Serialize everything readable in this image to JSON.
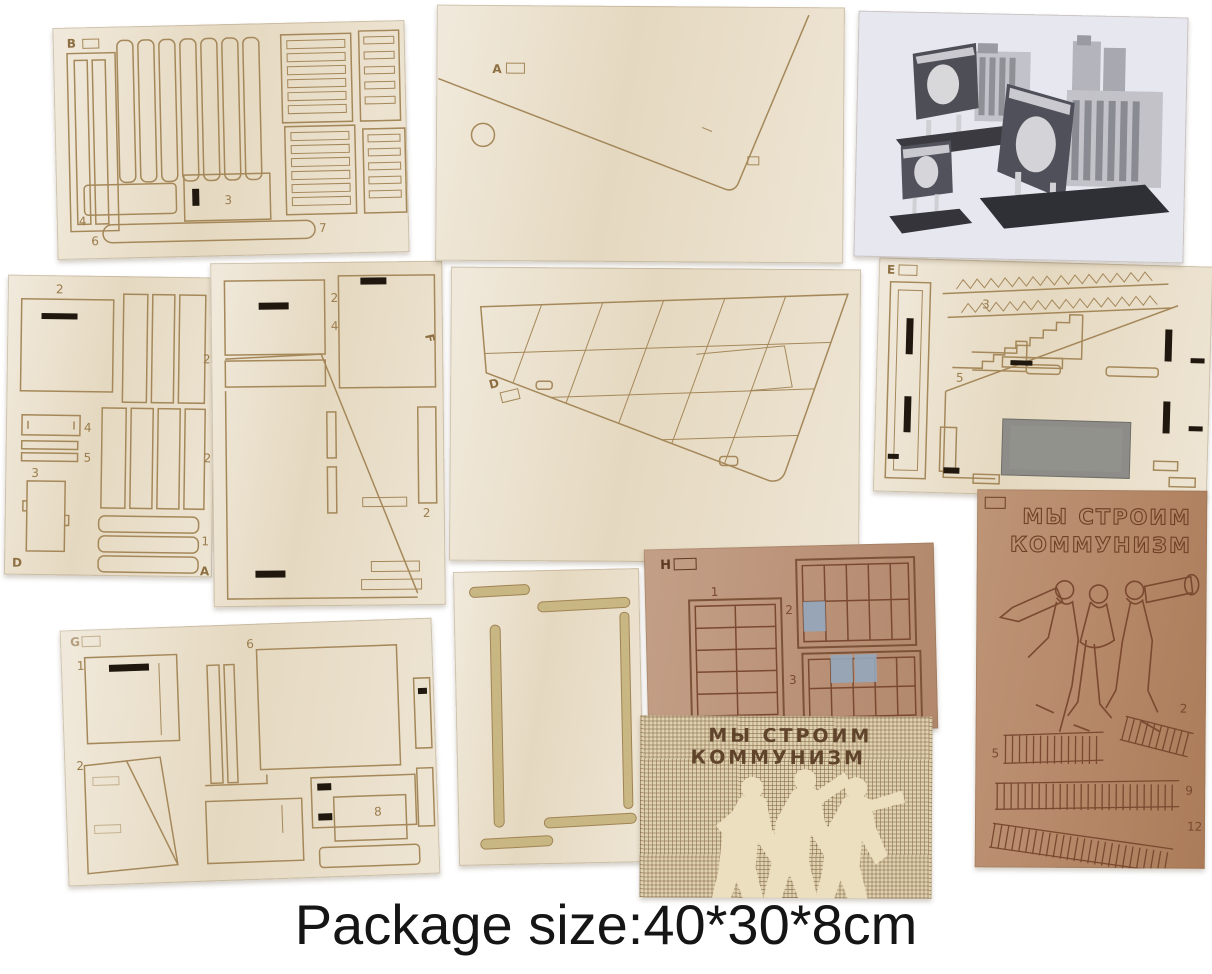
{
  "caption": "Package size:40*30*8cm",
  "colors": {
    "background": "#ffffff",
    "plywood": "#e9dec9",
    "engrave_line": "#a5885a",
    "brown_sheet": "#b3825f",
    "brown_sheet_h": "#b98e72",
    "checker_base": "#dfd2b0",
    "putty_blue": "#93a7bd",
    "photo_paper": "#e7e7f0",
    "gray_panel": "#8d8c88",
    "caption_color": "#151515"
  },
  "sheets": {
    "b": {
      "label": "B",
      "n3": "3",
      "n4": "4",
      "n6": "6",
      "n7": "7"
    },
    "a": {
      "label": "A"
    },
    "d_left": {
      "label": "D",
      "corner": "A",
      "n1": "1",
      "n2_top": "2",
      "n2_right": "2",
      "n2_mid": "2",
      "n3": "3",
      "n4": "4",
      "n5": "5"
    },
    "f": {
      "label": "F",
      "n2_top": "2",
      "n4": "4",
      "n2_right": "2"
    },
    "d_center": {
      "label": "D"
    },
    "e": {
      "label": "E",
      "n3": "3",
      "n5": "5"
    },
    "g": {
      "label": "G",
      "n1": "1",
      "n2": "2",
      "n6": "6",
      "n8": "8"
    },
    "h": {
      "label": "H",
      "n1": "1",
      "n2": "2",
      "n3": "3"
    },
    "billboard": {
      "slogan_line1": "МЫ СТРОИМ",
      "slogan_line2": "КОММУНИЗМ"
    },
    "r": {
      "slogan_line1": "МЫ СТРОИМ",
      "slogan_line2": "КОММУНИЗМ",
      "n2": "2",
      "n5": "5",
      "n9": "9",
      "n12": "12"
    }
  }
}
